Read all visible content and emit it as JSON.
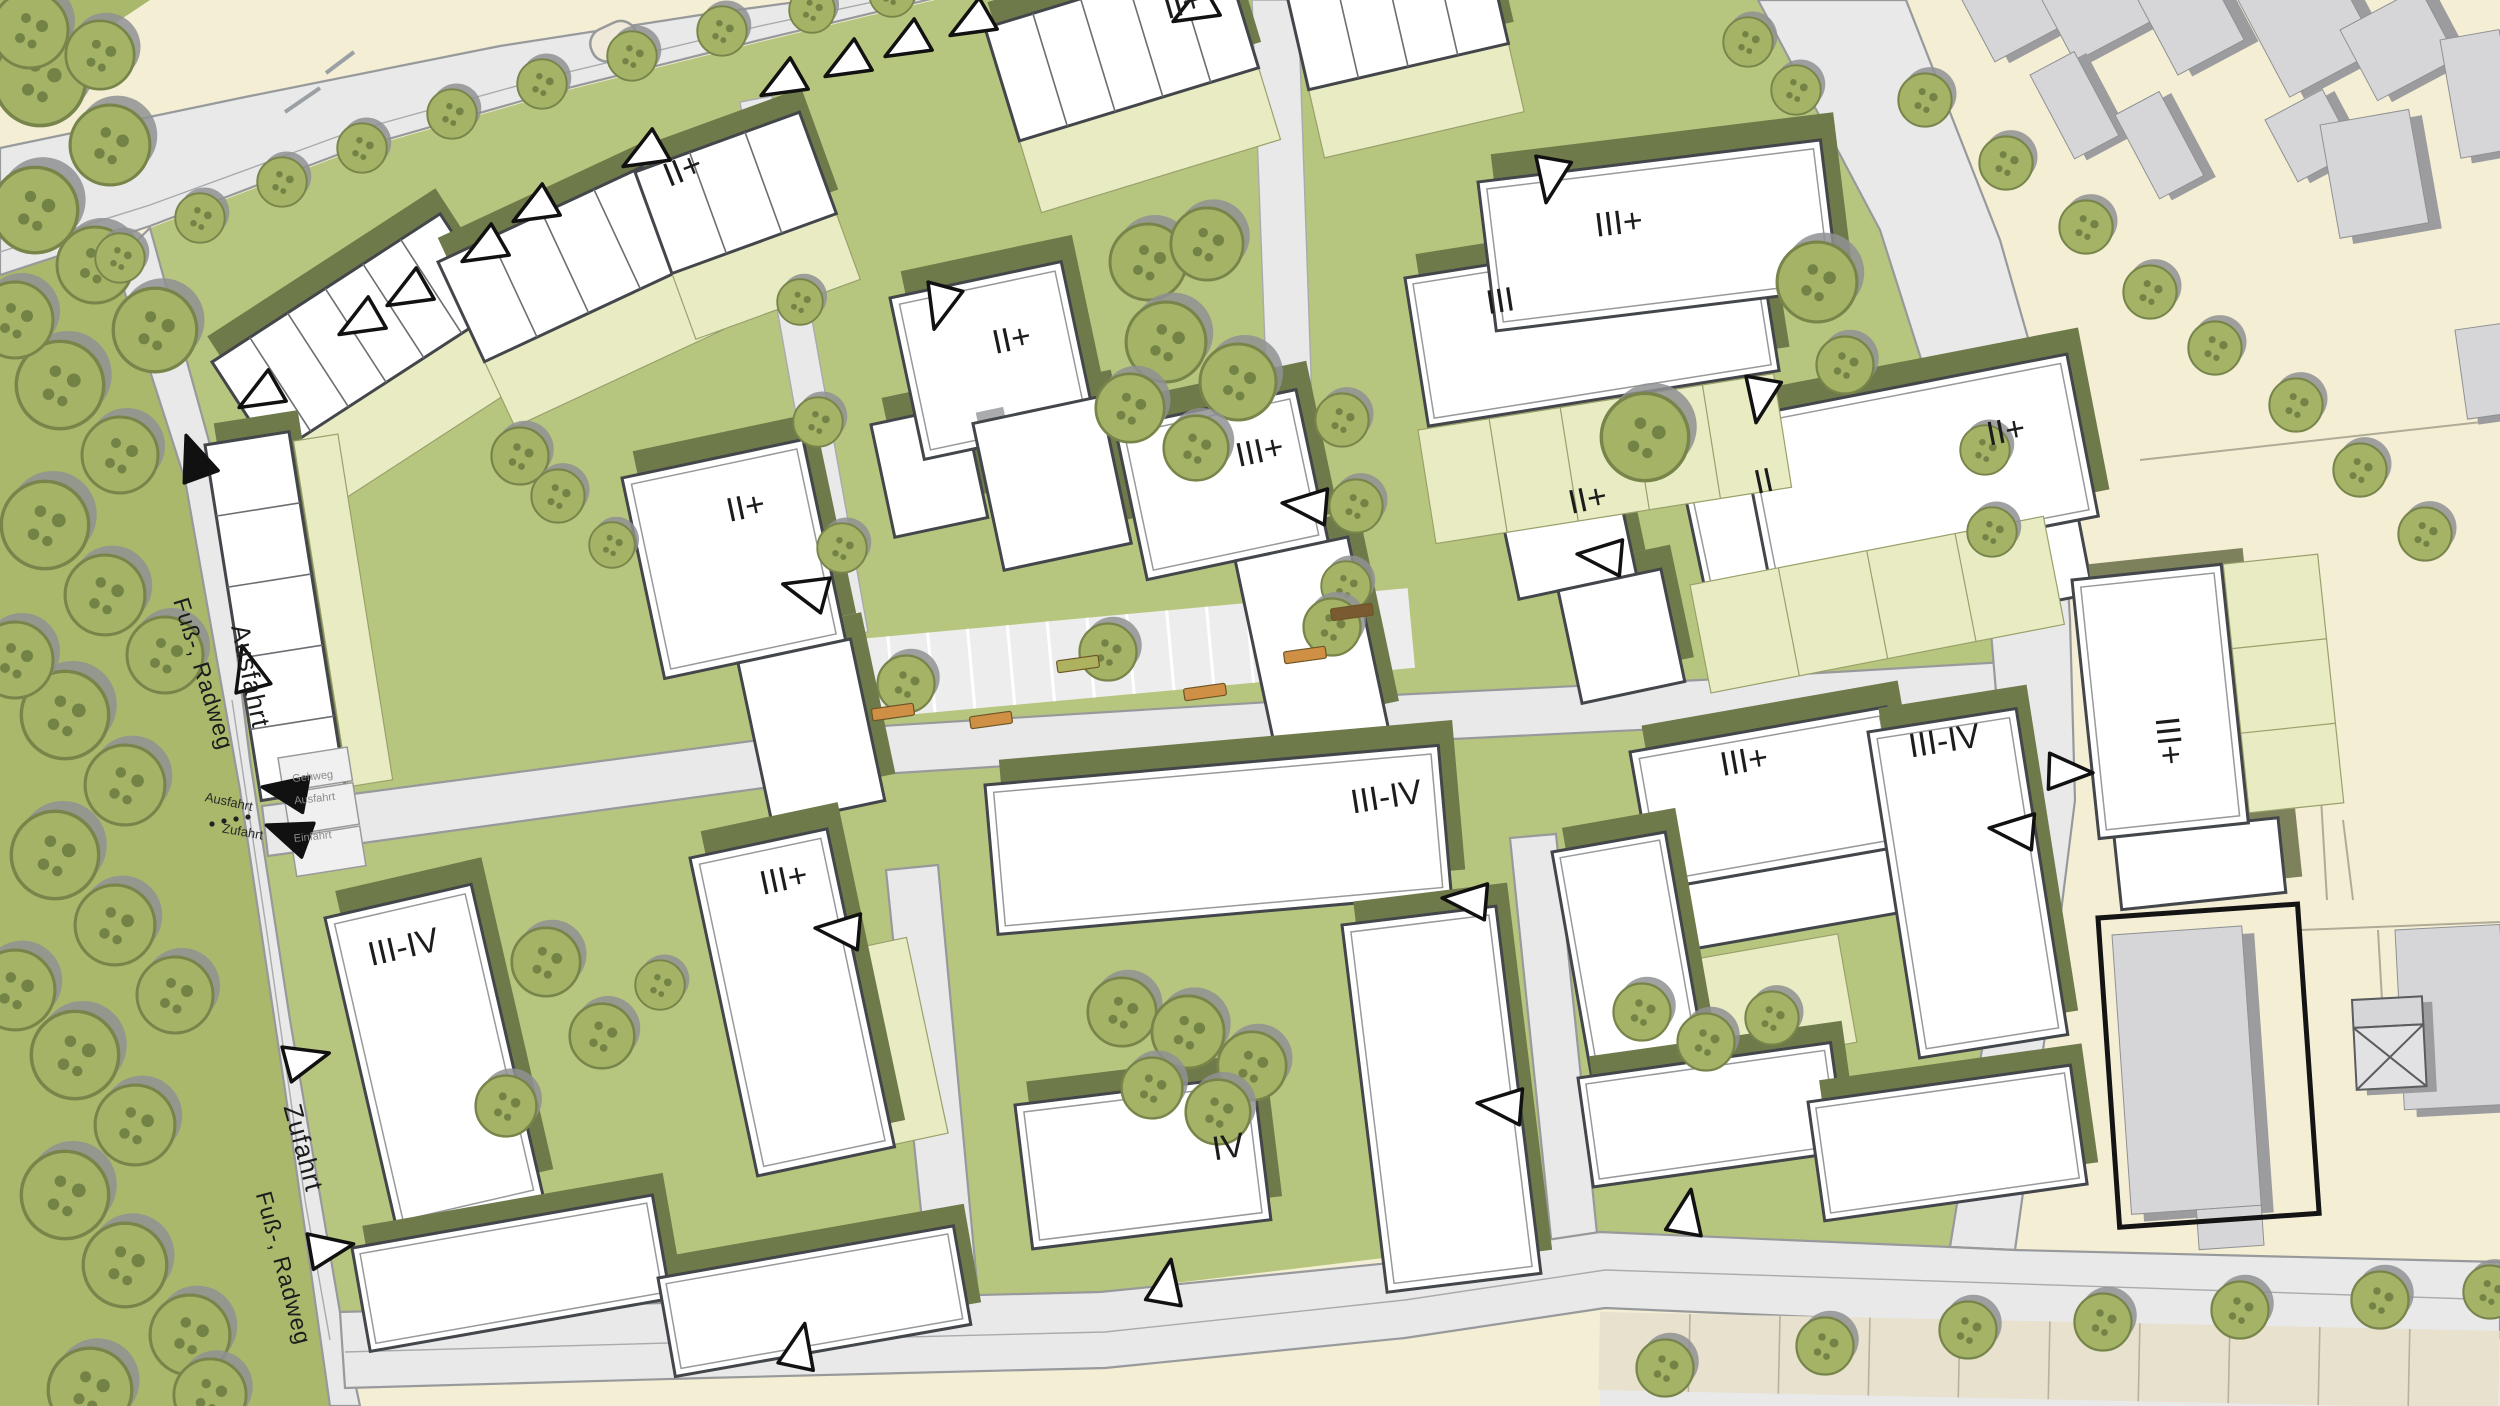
{
  "map": {
    "kind": "urban-site-plan",
    "building_labels": [
      {
        "id": "rowhouses-west",
        "label": "II+"
      },
      {
        "id": "rowhouses-north",
        "label": "II+"
      },
      {
        "id": "block-a-west",
        "label": "II+"
      },
      {
        "id": "block-b-center",
        "label": "II+"
      },
      {
        "id": "block-c-center",
        "label": "III+"
      },
      {
        "id": "block-d-east-1",
        "label": "II+"
      },
      {
        "id": "block-d-east-2",
        "label": "II"
      },
      {
        "id": "block-d-east-3",
        "label": "II+"
      },
      {
        "id": "block-e-ne-upper",
        "label": "III+"
      },
      {
        "id": "block-e-ne-lower",
        "label": "III"
      },
      {
        "id": "block-f-far-right",
        "label": "III+"
      },
      {
        "id": "block-g-sw",
        "label": "III-IV"
      },
      {
        "id": "block-g-mid",
        "label": "III+"
      },
      {
        "id": "block-h-center",
        "label": "III-IV"
      },
      {
        "id": "block-h-tower",
        "label": "IV"
      },
      {
        "id": "block-i-se",
        "label": "III+"
      },
      {
        "id": "block-i-se-east",
        "label": "III-IV"
      }
    ],
    "street_labels": [
      {
        "id": "fussradweg-north",
        "label": "Fuß-, Radweg"
      },
      {
        "id": "ausfahrt-road",
        "label": "Ausfahrt"
      },
      {
        "id": "zufahrt-road",
        "label": "Zufahrt"
      },
      {
        "id": "fussradweg-south",
        "label": "Fuß-, Radweg"
      },
      {
        "id": "ausfahrt-marking",
        "label": "Ausfahrt"
      },
      {
        "id": "zufahrt-marking",
        "label": "Zufahrt"
      },
      {
        "id": "garage-gehweg",
        "label": "Gehweg"
      },
      {
        "id": "garage-ausfahrt",
        "label": "Ausfahrt"
      },
      {
        "id": "garage-einfahrt",
        "label": "Einfahrt"
      }
    ],
    "colors": {
      "beige": "#f4eed5",
      "road": "#e9e9ea",
      "road_edge": "#97999b",
      "site_green": "#b7c67e",
      "parcel_pale": "#e9ecc2",
      "olive_shadow": "#6f7a4a",
      "tree_green": "#a4b366",
      "tree_dark": "#6e7c41",
      "tree_shadow": "#8f9193",
      "forest_base": "#a9b86b",
      "building_white": "#ffffff",
      "building_stroke": "#43464a",
      "existing_gray": "#d6d6d8",
      "existing_shadow": "#9c9c9e",
      "bench_orange": "#cf8f45",
      "label": "#1c1c1c"
    },
    "trees": [
      [
        40,
        80,
        48
      ],
      [
        110,
        145,
        42
      ],
      [
        35,
        210,
        45
      ],
      [
        95,
        265,
        40
      ],
      [
        155,
        330,
        44
      ],
      [
        60,
        385,
        46
      ],
      [
        120,
        455,
        40
      ],
      [
        45,
        525,
        46
      ],
      [
        105,
        595,
        42
      ],
      [
        165,
        655,
        40
      ],
      [
        65,
        715,
        46
      ],
      [
        125,
        785,
        42
      ],
      [
        55,
        855,
        46
      ],
      [
        115,
        925,
        42
      ],
      [
        175,
        995,
        40
      ],
      [
        75,
        1055,
        46
      ],
      [
        135,
        1125,
        42
      ],
      [
        65,
        1195,
        46
      ],
      [
        125,
        1265,
        44
      ],
      [
        190,
        1335,
        42
      ],
      [
        90,
        1390,
        44
      ],
      [
        15,
        320,
        40
      ],
      [
        15,
        660,
        40
      ],
      [
        15,
        990,
        42
      ],
      [
        210,
        1395,
        38
      ],
      [
        30,
        30,
        40
      ],
      [
        100,
        55,
        36
      ],
      [
        120,
        258,
        26
      ],
      [
        200,
        218,
        26
      ],
      [
        282,
        182,
        26
      ],
      [
        362,
        148,
        26
      ],
      [
        452,
        114,
        26
      ],
      [
        542,
        84,
        26
      ],
      [
        632,
        56,
        26
      ],
      [
        722,
        31,
        26
      ],
      [
        812,
        10,
        24
      ],
      [
        892,
        -6,
        24
      ],
      [
        1748,
        42,
        26
      ],
      [
        1796,
        90,
        26
      ],
      [
        1925,
        100,
        28
      ],
      [
        2006,
        163,
        28
      ],
      [
        2086,
        227,
        28
      ],
      [
        2150,
        292,
        28
      ],
      [
        2215,
        348,
        28
      ],
      [
        2296,
        405,
        28
      ],
      [
        2360,
        470,
        28
      ],
      [
        2425,
        534,
        28
      ],
      [
        1148,
        262,
        40
      ],
      [
        1207,
        244,
        38
      ],
      [
        1166,
        342,
        42
      ],
      [
        1238,
        382,
        40
      ],
      [
        1130,
        408,
        36
      ],
      [
        1196,
        448,
        34
      ],
      [
        520,
        456,
        30
      ],
      [
        558,
        496,
        28
      ],
      [
        612,
        545,
        24
      ],
      [
        1817,
        282,
        42
      ],
      [
        1845,
        365,
        30
      ],
      [
        1645,
        437,
        46
      ],
      [
        1985,
        450,
        26
      ],
      [
        1992,
        532,
        26
      ],
      [
        800,
        302,
        24
      ],
      [
        818,
        422,
        26
      ],
      [
        842,
        548,
        26
      ],
      [
        1342,
        420,
        28
      ],
      [
        1356,
        506,
        28
      ],
      [
        1346,
        586,
        26
      ],
      [
        906,
        684,
        30
      ],
      [
        1108,
        652,
        30
      ],
      [
        1332,
        627,
        30
      ],
      [
        546,
        962,
        36
      ],
      [
        602,
        1036,
        34
      ],
      [
        506,
        1106,
        32
      ],
      [
        660,
        985,
        26
      ],
      [
        1122,
        1012,
        36
      ],
      [
        1188,
        1032,
        38
      ],
      [
        1252,
        1066,
        36
      ],
      [
        1152,
        1088,
        32
      ],
      [
        1218,
        1112,
        34
      ],
      [
        1642,
        1012,
        30
      ],
      [
        1706,
        1042,
        30
      ],
      [
        1772,
        1018,
        28
      ],
      [
        1665,
        1368,
        30
      ],
      [
        1825,
        1346,
        30
      ],
      [
        1968,
        1330,
        30
      ],
      [
        2103,
        1322,
        30
      ],
      [
        2240,
        1310,
        30
      ],
      [
        2380,
        1300,
        30
      ],
      [
        2490,
        1292,
        28
      ]
    ],
    "arrows": [
      [
        259,
        396,
        150,
        "#ffffff"
      ],
      [
        359,
        323,
        150,
        "#ffffff"
      ],
      [
        407,
        294,
        150,
        "#ffffff"
      ],
      [
        482,
        250,
        150,
        "#ffffff"
      ],
      [
        533,
        210,
        150,
        "#ffffff"
      ],
      [
        643,
        155,
        150,
        "#ffffff"
      ],
      [
        781,
        84,
        150,
        "#ffffff"
      ],
      [
        845,
        65,
        150,
        "#ffffff"
      ],
      [
        905,
        45,
        150,
        "#ffffff"
      ],
      [
        970,
        24,
        150,
        "#ffffff"
      ],
      [
        1193,
        10,
        150,
        "#ffffff"
      ],
      [
        940,
        307,
        105,
        "#ffffff"
      ],
      [
        1550,
        180,
        100,
        "#ffffff"
      ],
      [
        1760,
        400,
        100,
        "#ffffff"
      ],
      [
        1305,
        505,
        185,
        "#ffffff"
      ],
      [
        1600,
        556,
        185,
        "#ffffff"
      ],
      [
        805,
        590,
        195,
        "#ffffff"
      ],
      [
        248,
        668,
        255,
        "#ffffff"
      ],
      [
        1465,
        900,
        185,
        "#ffffff"
      ],
      [
        838,
        930,
        185,
        "#ffffff"
      ],
      [
        1500,
        1105,
        185,
        "#ffffff"
      ],
      [
        1687,
        1212,
        280,
        "#ffffff"
      ],
      [
        1167,
        1282,
        280,
        "#ffffff"
      ],
      [
        800,
        1346,
        282,
        "#ffffff"
      ],
      [
        307,
        1059,
        345,
        "#ffffff"
      ],
      [
        331,
        1248,
        350,
        "#ffffff"
      ],
      [
        2070,
        772,
        2,
        "#ffffff"
      ],
      [
        2012,
        830,
        185,
        "#ffffff"
      ],
      [
        194,
        457,
        250,
        "#111111"
      ],
      [
        285,
        791,
        190,
        "#111111"
      ],
      [
        288,
        833,
        200,
        "#111111"
      ]
    ],
    "benches": [
      [
        893,
        712,
        -8,
        "#cf8f45"
      ],
      [
        991,
        720,
        -8,
        "#cf8f45"
      ],
      [
        1205,
        692,
        -8,
        "#cf8f45"
      ],
      [
        1305,
        655,
        -8,
        "#cf8f45"
      ],
      [
        1078,
        664,
        -8,
        "#aeb15e"
      ],
      [
        1352,
        612,
        -8,
        "#7a5a30"
      ]
    ]
  }
}
